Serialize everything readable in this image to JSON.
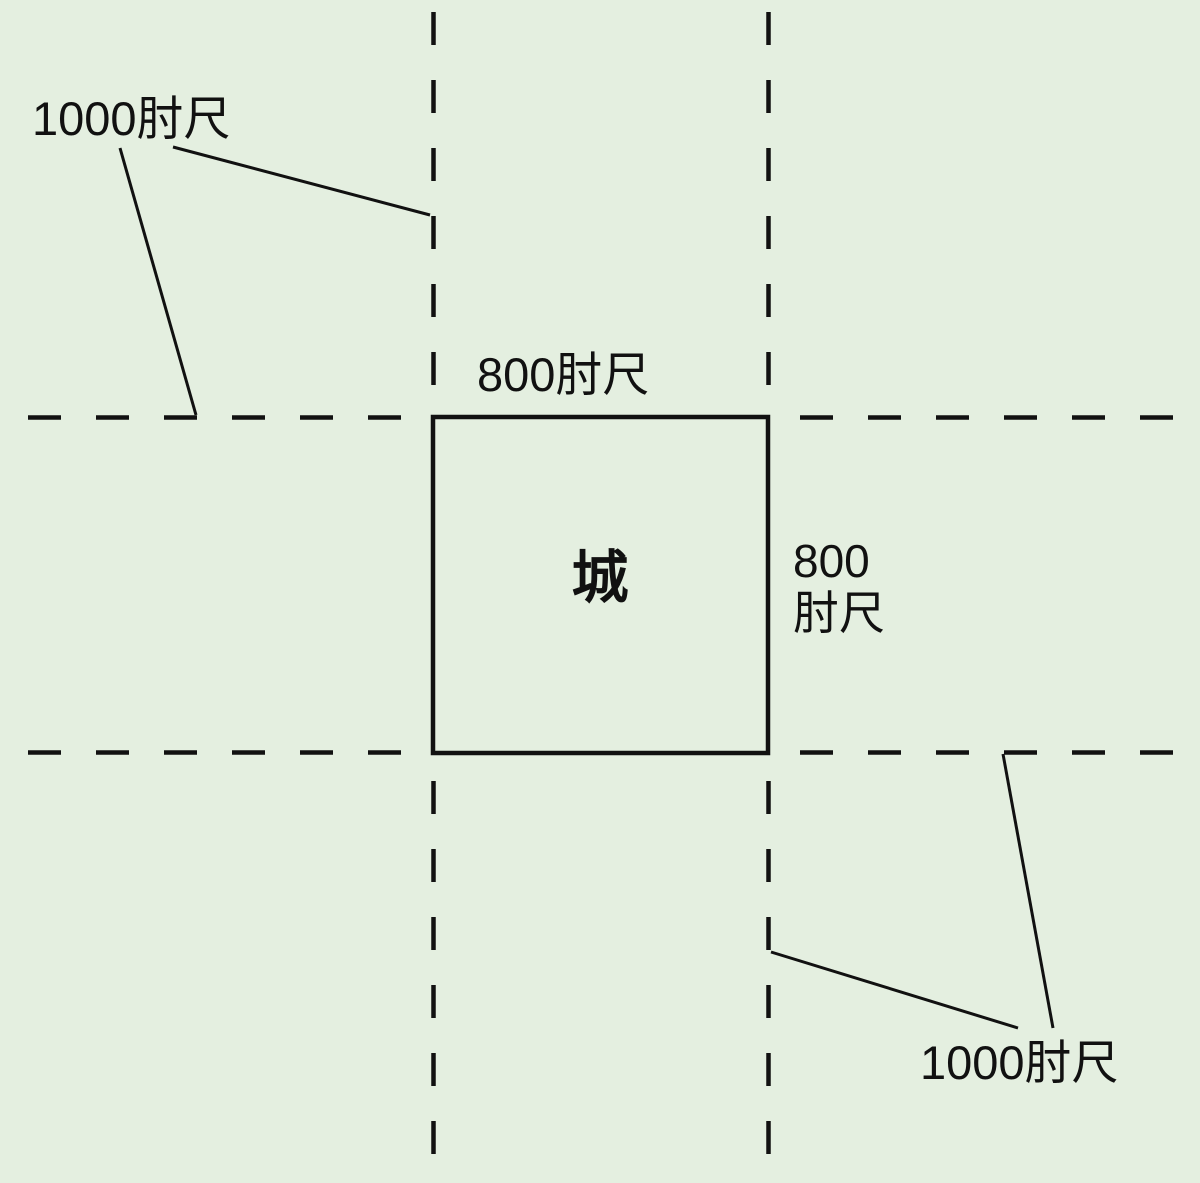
{
  "diagram": {
    "title_semantic": "city-with-pasture-lands-measurement-diagram",
    "background_color": "#e4efe0",
    "line_color": "#111111",
    "city": {
      "label": "城",
      "side_top_label": "800肘尺",
      "side_right_label_line1": "800",
      "side_right_label_line2": "肘尺"
    },
    "callouts": {
      "top_left_label": "1000肘尺",
      "bottom_right_label": "1000肘尺"
    }
  }
}
